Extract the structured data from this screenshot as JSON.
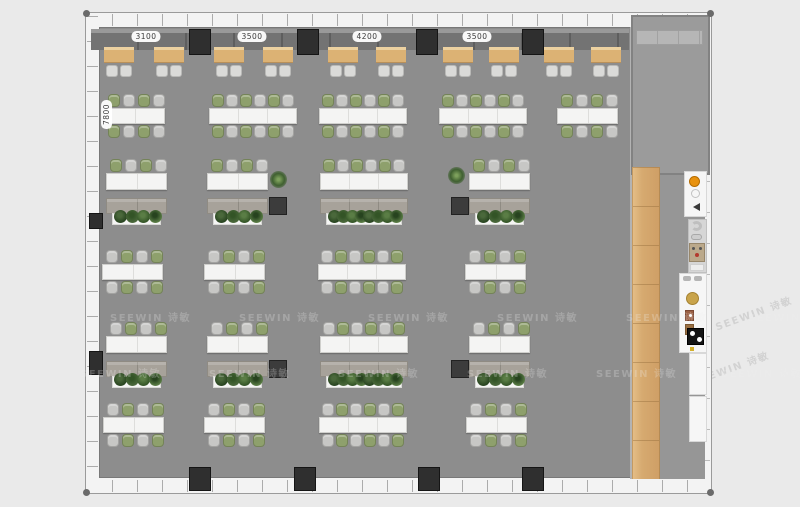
{
  "watermark": {
    "text": "SEEWIN 诗敏",
    "rows": [
      {
        "y": 296,
        "xs": [
          24,
          153,
          282,
          411,
          540,
          662
        ]
      },
      {
        "y": 352,
        "xs": [
          -6,
          123,
          252,
          381,
          510,
          635
        ]
      }
    ],
    "background": [
      {
        "x": 713,
        "y": 305
      },
      {
        "x": 690,
        "y": 360
      }
    ]
  },
  "dimensions": {
    "top": [
      {
        "label": "3100",
        "cx": 60
      },
      {
        "label": "3500",
        "cx": 166
      },
      {
        "label": "4200",
        "cx": 281
      },
      {
        "label": "3500",
        "cx": 391
      }
    ],
    "left": {
      "label": "7800",
      "x": 6,
      "y": 96
    }
  },
  "colors": {
    "floor": "#8d8d8d",
    "room_floor": "#9b9b9b",
    "desk": "#f4f4f3",
    "chair_gray": "#c7c7c5",
    "chair_green": "#8ea06c",
    "booth_table": "#dcb274",
    "cabinet": "#a7a29a",
    "column": "#2f2f2f",
    "planter": "#f5f5f4"
  },
  "furniture": {
    "bench": {
      "x": 5,
      "y": 16,
      "w": 538,
      "h": 17
    },
    "booth_tables_x": [
      18,
      68,
      128,
      177,
      242,
      290,
      357,
      403,
      458,
      505
    ],
    "columns_top": [
      103,
      211,
      330,
      436
    ],
    "columns_bottom": [
      103,
      208,
      332,
      436
    ],
    "columns_left": [
      {
        "y": 200,
        "h": 16
      },
      {
        "y": 338,
        "h": 24
      }
    ],
    "workstation_rows": [
      {
        "y": 81,
        "start": "green",
        "clusters": [
          {
            "x": 18,
            "seats": 4
          },
          {
            "x": 123,
            "seats": 6
          },
          {
            "x": 233,
            "seats": 6
          },
          {
            "x": 353,
            "seats": 6
          },
          {
            "x": 471,
            "seats": 4
          }
        ]
      },
      {
        "y": 237,
        "start": "gray",
        "clusters": [
          {
            "x": 16,
            "seats": 4
          },
          {
            "x": 118,
            "seats": 4
          },
          {
            "x": 232,
            "seats": 6
          },
          {
            "x": 379,
            "seats": 4
          }
        ]
      },
      {
        "y": 390,
        "start": "gray",
        "clusters": [
          {
            "x": 17,
            "seats": 4
          },
          {
            "x": 118,
            "seats": 4
          },
          {
            "x": 233,
            "seats": 6
          },
          {
            "x": 380,
            "seats": 4
          }
        ]
      }
    ],
    "focus_rows": [
      {
        "y": 146,
        "start": "green",
        "groups": [
          {
            "x": 20,
            "seats": 4
          },
          {
            "x": 121,
            "seats": 4,
            "dark": "right",
            "plant": "right"
          },
          {
            "x": 234,
            "seats": 6
          },
          {
            "x": 383,
            "seats": 4,
            "dark": "left",
            "plant": "left"
          }
        ]
      },
      {
        "y": 309,
        "start": "gray",
        "groups": [
          {
            "x": 20,
            "seats": 4
          },
          {
            "x": 121,
            "seats": 4,
            "dark": "right"
          },
          {
            "x": 234,
            "seats": 6
          },
          {
            "x": 383,
            "seats": 4,
            "dark": "left"
          }
        ]
      }
    ]
  }
}
